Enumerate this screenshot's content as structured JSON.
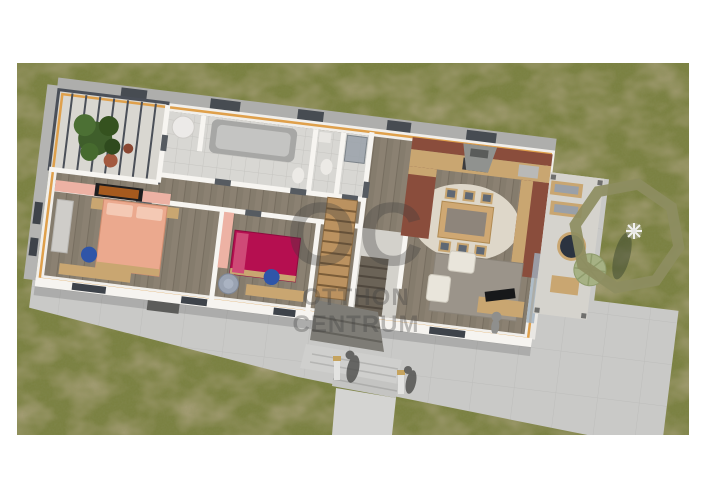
{
  "page": {
    "background": "#ffffff"
  },
  "scene": {
    "type": "3d-floorplan-render",
    "ground": {
      "grass": "#7b8142",
      "grass_patch": "#70603a",
      "concrete": "#c9c9c7",
      "walkway": "#d4d4d2"
    },
    "house": {
      "wall": "#f1efeb",
      "wall_top_strip": "#dfa04b",
      "roof_band": "#aeaeac",
      "window": "#3e434a",
      "floor_wood": "#8b8172",
      "floor_tile": "#d8d7d3",
      "pergola_frame": "#4a4f58",
      "foliage": "#3f5e2b",
      "plant_pot": "#a3593f"
    },
    "rooms": {
      "master_bedroom": {
        "bed": "#eba98e",
        "pillow": "#f4c9b4",
        "accent_wall": "#edb2a4",
        "tv": "#1d1d1f",
        "desk_chair": "#2f55a8",
        "desk": "#c9a671"
      },
      "kids_bedroom": {
        "bed": "#b50f50",
        "pillow": "#cf4a77",
        "pouf": "#9aa3b2"
      },
      "bathroom": {
        "tub": "#a7a7a5",
        "tub_inner": "#c4c4c2",
        "heater": "#eceae8"
      },
      "kitchen": {
        "counter_wood": "#c9a671",
        "backsplash": "#8a4d3c",
        "hood": "#90928f",
        "cooktop": "#3c3c3e",
        "dining_rug": "#ded7c9",
        "table": "#cfa873",
        "chair_seat": "#5f6874"
      },
      "living_room": {
        "sofa": "#e9e5db",
        "rug": "#9b948a",
        "tv": "#17181a",
        "cabinet": "#c9a671",
        "glazing": "#9fb0bf"
      },
      "hall": {
        "stair": "#bb9260"
      }
    },
    "terrace": {
      "floor": "#d5d3cd",
      "round_table": "#2b3340",
      "umbrella": "#a6b184",
      "cushion": "#9aa0a8",
      "lounge_wood": "#c9a671"
    },
    "annotation": {
      "shape": "octagon",
      "color": "#8d8d61",
      "parasol": "#f2f2f0",
      "parasol_shadow": "#39452e"
    }
  },
  "watermark": {
    "logo": "OC",
    "line1": "OTTHON",
    "line2": "CENTRUM",
    "color": "#3c3c3c"
  }
}
